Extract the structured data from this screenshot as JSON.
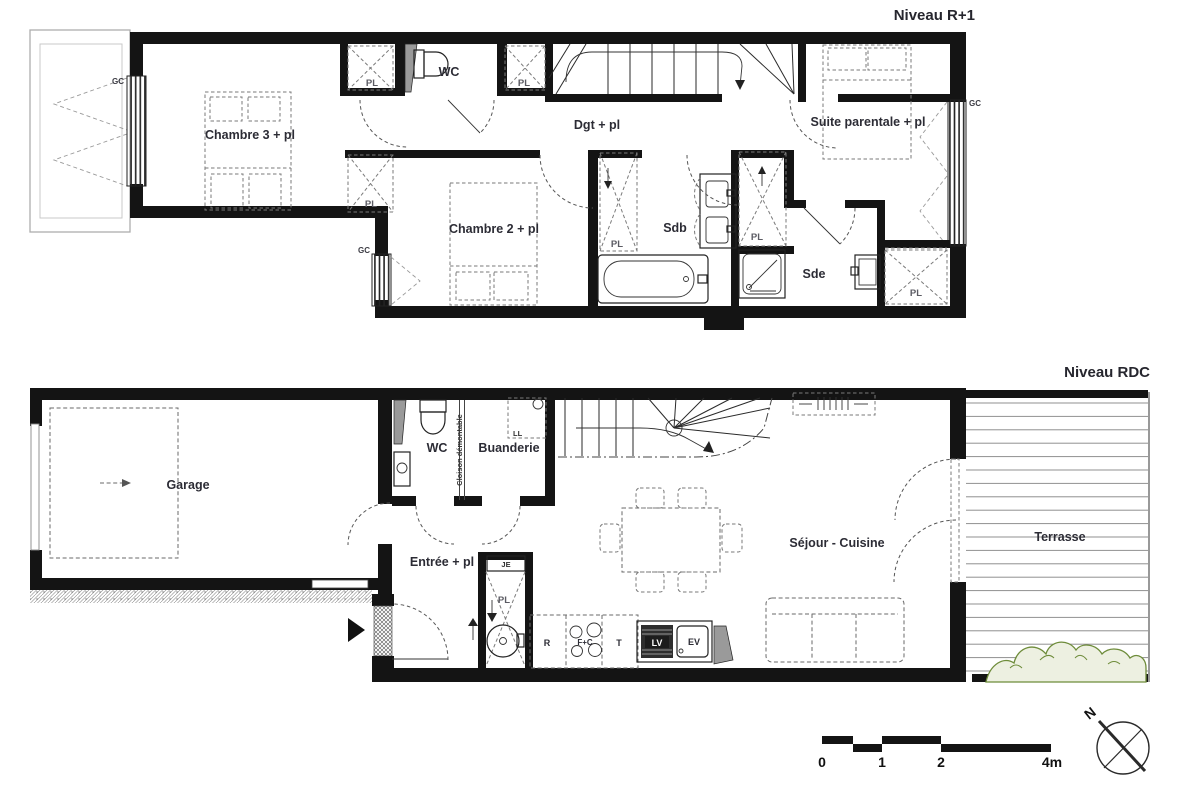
{
  "titles": {
    "r1": "Niveau R+1",
    "rdc": "Niveau RDC"
  },
  "r1": {
    "chambre3": "Chambre 3 + pl",
    "wc": "WC",
    "dgt": "Dgt + pl",
    "suite": "Suite parentale + pl",
    "chambre2": "Chambre 2 + pl",
    "sdb": "Sdb",
    "sde": "Sde"
  },
  "rdc": {
    "garage": "Garage",
    "wc": "WC",
    "buanderie": "Buanderie",
    "cloison": "Cloison démontable",
    "entree": "Entrée + pl",
    "sejour": "Séjour - Cuisine",
    "terrasse": "Terrasse"
  },
  "tags": {
    "pl": "PL",
    "gc": "GC",
    "ll": "LL",
    "je": "JE"
  },
  "appliances": {
    "r": "R",
    "fc": "F+C",
    "t": "T",
    "lv": "LV",
    "ev": "EV"
  },
  "scale_bar": {
    "ticks": [
      "0",
      "1",
      "2",
      "4m"
    ]
  },
  "compass": {
    "north": "N"
  },
  "colors": {
    "wall": "#141414",
    "label": "#2c2c35",
    "green_stroke": "#6e8c3a",
    "green_fill": "#edf0e1"
  }
}
